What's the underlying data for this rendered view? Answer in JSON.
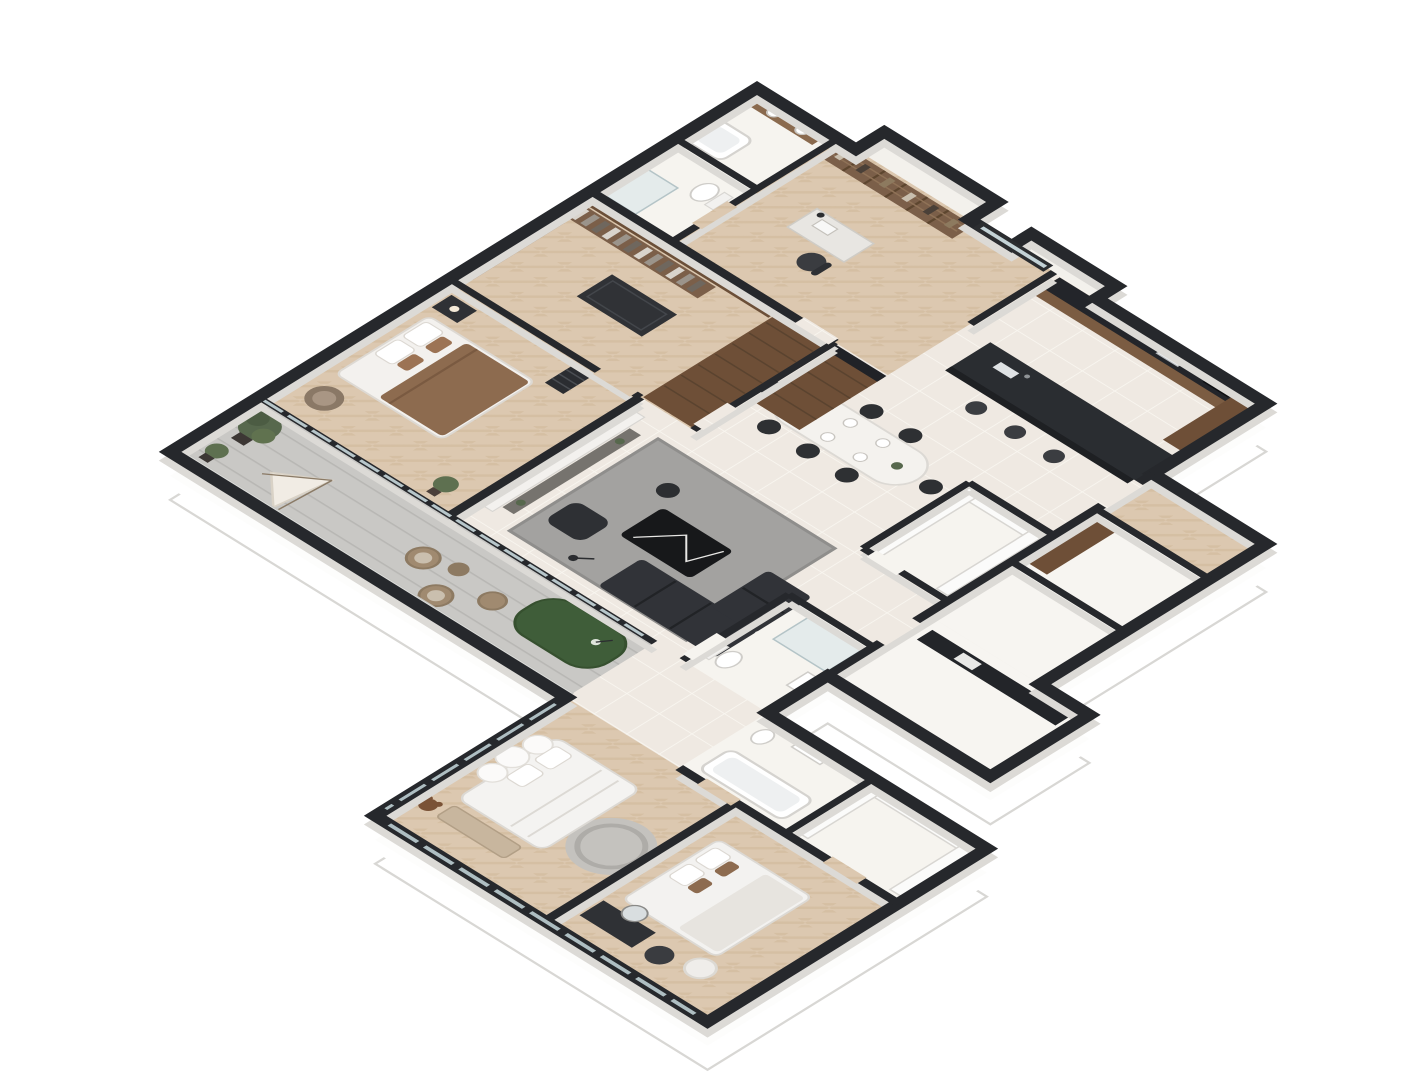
{
  "scene": {
    "kind": "isometric-3d-floor-plan-render",
    "description": "Isometric dollhouse cutaway render of a large apartment, viewed from above at 45 degrees, no text labels",
    "background": "#ffffff"
  },
  "palette": {
    "wall_top": "#26282c",
    "wall_face_white": "#ffffff",
    "plinth_edge": "#d8d7d4",
    "wood_floor": "#dcc8b0",
    "tile_floor": "#efe9e2",
    "balcony_floor": "#c9c8c5",
    "bathroom_floor": "#f6f4ef",
    "cabinet_wood": "#6e4f37",
    "shelf_wood": "#7b5f49",
    "counter_dark": "#232529",
    "island_dark": "#2a2d31",
    "sofa_charcoal": "#313338",
    "rug_gray": "#a3a2a0",
    "coffee_table_black_marble": "#17181a",
    "marble_white": "#f3f1ee",
    "tv_black": "#0b0c0d",
    "bed_white": "#f3f1ee",
    "throw_brown": "#8d6b4f",
    "plant_green": "#57684d",
    "putting_green": "#3f5d39",
    "glass": "#b7c6ca",
    "wicker_tan": "#a08a70"
  },
  "rooms": [
    {
      "id": "bathroom-1",
      "name": "Bathroom with double vanity and bathtub",
      "furniture": [
        "wood vanity",
        "two sinks",
        "bathtub"
      ]
    },
    {
      "id": "bathroom-2",
      "name": "Shower bathroom",
      "furniture": [
        "glass shower",
        "toilet"
      ]
    },
    {
      "id": "home-office",
      "name": "Home office study",
      "furniture": [
        "full-wall bookshelf",
        "desk with lamp",
        "office chair",
        "window"
      ]
    },
    {
      "id": "kitchen",
      "name": "Kitchen",
      "furniture": [
        "wall counter with sink and cooktop",
        "tall cabinet",
        "dark island with sink",
        "three bar stools"
      ]
    },
    {
      "id": "dining-area",
      "name": "Dining area",
      "furniture": [
        "oval white dining table",
        "eight black chairs",
        "place settings"
      ]
    },
    {
      "id": "pantry",
      "name": "Pantry storage",
      "furniture": [
        "U-shaped white shelving"
      ]
    },
    {
      "id": "walk-in-closet",
      "name": "Walk-in closet",
      "furniture": [
        "hanging clothes rail",
        "island dresser",
        "wood shelving"
      ]
    },
    {
      "id": "hallway-wardrobes",
      "name": "Hallway wardrobe cabinets",
      "furniture": [
        "brown wardrobe row",
        "dark countertop"
      ]
    },
    {
      "id": "master-bedroom",
      "name": "Master bedroom",
      "furniture": [
        "double bed with brown throw",
        "pillows",
        "nightstand with lamp",
        "bookshelf tower",
        "armchair",
        "potted plant",
        "wood panel wall"
      ]
    },
    {
      "id": "tv-wall",
      "name": "Marble TV wall with media console",
      "furniture": [
        "white marble panel",
        "flat TV",
        "low console",
        "plants"
      ]
    },
    {
      "id": "living-room",
      "name": "Living room",
      "furniture": [
        "gray rug",
        "black marble coffee table",
        "charcoal corner sofa",
        "black lounge chair",
        "floor lamp",
        "round side table"
      ]
    },
    {
      "id": "powder-room",
      "name": "Powder room",
      "furniture": [
        "toilet",
        "glass shower",
        "washbasin"
      ]
    },
    {
      "id": "balcony",
      "name": "Balcony terrace",
      "furniture": [
        "potted trees",
        "kids teepee tent",
        "wicker lounge chairs",
        "pouf",
        "putting green with flag",
        "glass railing"
      ]
    },
    {
      "id": "kids-bedroom",
      "name": "Kids bedroom",
      "furniture": [
        "cloud headboard bed",
        "round rug",
        "teddy bear",
        "foot bench",
        "wall art"
      ]
    },
    {
      "id": "guest-bedroom",
      "name": "Guest bedroom",
      "furniture": [
        "double bed",
        "dark dresser with round mirror",
        "black pouf",
        "white fluffy chair"
      ]
    },
    {
      "id": "bathroom-3",
      "name": "Family bathroom",
      "furniture": [
        "bathtub",
        "vanity",
        "toilet"
      ]
    },
    {
      "id": "linen-closet",
      "name": "Linen closet",
      "furniture": [
        "U-shaped white shelving"
      ]
    },
    {
      "id": "entry-hall",
      "name": "Entry corridor with wood floor",
      "furniture": [
        "wardrobe cabinet"
      ]
    },
    {
      "id": "side-rooms",
      "name": "Unfurnished side rooms",
      "furniture": [
        "dark countertop run"
      ]
    },
    {
      "id": "service-ledges",
      "name": "Exterior service ledges"
    }
  ]
}
